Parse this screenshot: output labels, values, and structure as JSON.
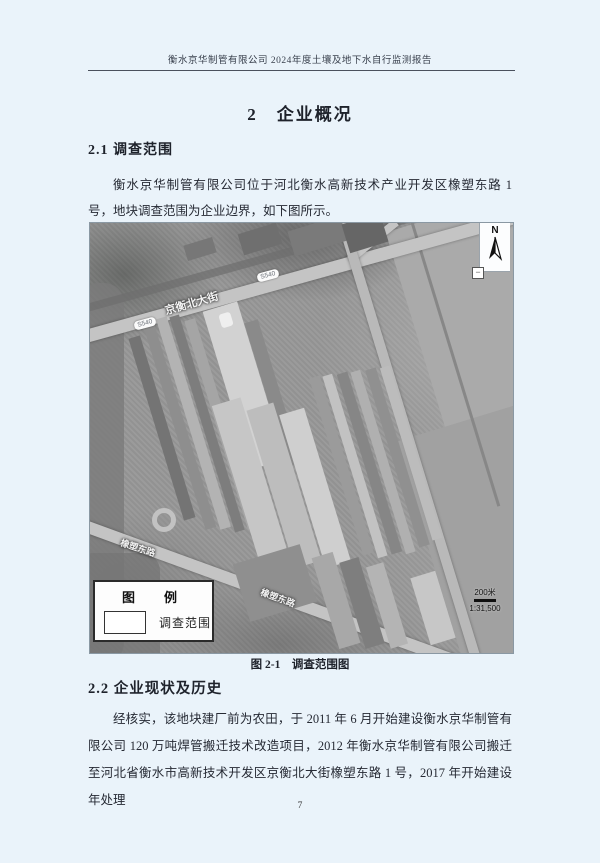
{
  "page": {
    "header": {
      "title": "衡水京华制管有限公司 2024年度土壤及地下水自行监测报告"
    },
    "chapter_title": "2　企业概况",
    "sections": [
      {
        "heading": "2.1 调查范围",
        "paragraph": "衡水京华制管有限公司位于河北衡水高新技术产业开发区橡塑东路 1 号，地块调查范围为企业边界，如下图所示。"
      },
      {
        "heading": "2.2 企业现状及历史",
        "paragraph": "经核实，该地块建厂前为农田，于 2011 年 6 月开始建设衡水京华制管有限公司 120 万吨焊管搬迁技术改造项目，2012 年衡水京华制管有限公司搬迁至河北省衡水市高新技术开发区京衡北大街橡塑东路 1 号，2017 年开始建设年处理"
      }
    ],
    "figure": {
      "caption": "图 2-1　调查范围图",
      "map": {
        "north_label": "N",
        "zoom_out": "−",
        "legend_title": "图　例",
        "legend_item": "调查范围",
        "scale_bar": "200米",
        "scale_ratio": "1:31,500",
        "road_labels": {
          "main_street": "京衡北大街",
          "east_road": "橡塑东路",
          "badge": "S540"
        }
      }
    },
    "footer": {
      "page_number": "7"
    },
    "colors": {
      "page_background": "#eaf3fa",
      "text": "#23262e",
      "map_base": "#989898"
    }
  }
}
